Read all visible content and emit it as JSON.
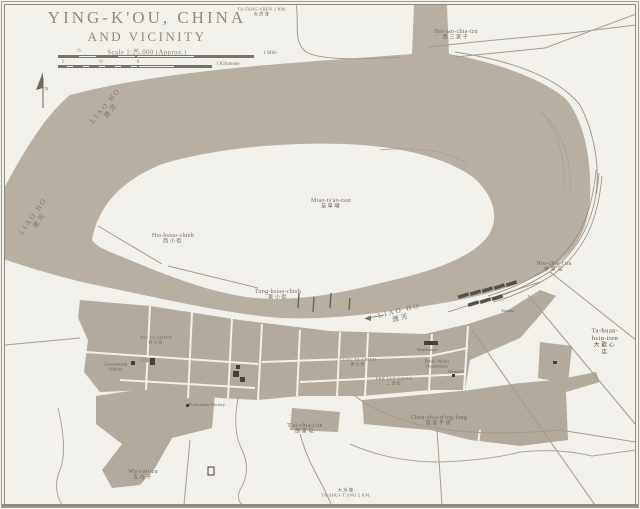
{
  "title": {
    "line1": "YING-K'OU, CHINA",
    "line2": "AND VICINITY",
    "scale_note": "Scale 1:25,000 (Approx.)"
  },
  "compass": {
    "letter": "N"
  },
  "scale_bars": {
    "mile": {
      "labels": [
        {
          "t": "½",
          "x": 21
        },
        {
          "t": "0",
          "x": 78
        }
      ],
      "end_label": "1 Mile",
      "x": 58,
      "y": 46,
      "bar_y": 9,
      "zero": 78,
      "total": 196,
      "left_segs": 4,
      "right_segs": 2
    },
    "km": {
      "labels": [
        {
          "t": "1",
          "x": 5
        },
        {
          "t": "½",
          "x": 43
        },
        {
          "t": "0",
          "x": 80
        }
      ],
      "end_label": "1 Kilometer",
      "x": 58,
      "y": 57,
      "bar_y": 8,
      "zero": 80,
      "total": 154,
      "left_segs": 10,
      "right_segs": 2
    }
  },
  "colors": {
    "paper": "#f1f0ea",
    "water": "#b6afa2",
    "builtup": "#b2ab9d",
    "ink": "#6f695c",
    "title_ink": "#8f8a76",
    "line": "#a29b8d",
    "building": "#45413a"
  },
  "map_labels": [
    {
      "id": "ta-fang-shen",
      "cls": "edge",
      "roman": "TA-FANG-SHEN 2 KM.",
      "chinese": "大房身",
      "x": 262,
      "y": 12,
      "order": "rc"
    },
    {
      "id": "hsi-san-chia-tzu",
      "cls": "place",
      "roman": "Hsi-san-chia-tzu",
      "chinese": "西三家子",
      "x": 456,
      "y": 34,
      "order": "rc"
    },
    {
      "id": "miao-tsao-tsui",
      "cls": "place",
      "roman": "Miao-ts'ao-tsui",
      "chinese": "苗草嘴",
      "x": 331,
      "y": 203,
      "order": "rc"
    },
    {
      "id": "hsi-hsiao-chieh",
      "cls": "place",
      "roman": "Hsi-hsiao-chieh",
      "chinese": "西小街",
      "x": 173,
      "y": 238,
      "order": "rc"
    },
    {
      "id": "tung-hsiao-chieh",
      "cls": "place",
      "roman": "Tung-hsiao-chieh",
      "chinese": "東小街",
      "x": 278,
      "y": 294,
      "order": "rc"
    },
    {
      "id": "niu-chia-tun",
      "cls": "place",
      "roman": "Niu-chia-t'un",
      "chinese": "牛家屯",
      "x": 554,
      "y": 266,
      "order": "rc"
    },
    {
      "id": "ta-huan-hsin-tien",
      "cls": "place-strong",
      "roman": "Ta-huan-hsin-tien",
      "chinese": "大歡心店",
      "x": 605,
      "y": 341,
      "order": "rc"
    },
    {
      "id": "chou-chia-ping-fang",
      "cls": "place",
      "roman": "Chou-chia-p'ing-fang",
      "chinese": "周家平房",
      "x": 439,
      "y": 420,
      "order": "rc"
    },
    {
      "id": "tai-chia-tun",
      "cls": "place",
      "roman": "T'ai-chia-t'un",
      "chinese": "邰家屯",
      "x": 305,
      "y": 428,
      "order": "rc"
    },
    {
      "id": "wu-tai-tzu",
      "cls": "place",
      "roman": "Wu-t'ai-tzu",
      "chinese": "五台子",
      "x": 143,
      "y": 474,
      "order": "rc"
    },
    {
      "id": "ta-shui-tang",
      "cls": "edge",
      "roman": "TA-SHUI-T'ANG 2 KM.",
      "chinese": "大水塘",
      "x": 346,
      "y": 493,
      "order": "cr"
    },
    {
      "id": "liao-ho-upper",
      "cls": "river-lbl",
      "roman": "LIAO HO",
      "chinese": "遼河",
      "x": 108,
      "y": 108,
      "rot": -50,
      "order": "rc"
    },
    {
      "id": "liao-ho-west",
      "cls": "river-lbl",
      "roman": "LIAO HO",
      "chinese": "遼河",
      "x": 36,
      "y": 218,
      "rot": -55,
      "order": "rc"
    },
    {
      "id": "liao-ho-main",
      "cls": "river-lbl",
      "roman": "LIAO HO",
      "chinese": "遼河",
      "x": 400,
      "y": 314,
      "rot": -14,
      "order": "rc"
    },
    {
      "id": "government-offices",
      "cls": "poi",
      "roman": "Government\nOffices",
      "x": 116,
      "y": 367,
      "order": "r"
    },
    {
      "id": "warehouse",
      "cls": "poi",
      "roman": "Warehouse",
      "x": 427,
      "y": 350,
      "order": "r"
    },
    {
      "id": "public-works-department",
      "cls": "poi",
      "roman": "Public Works\nDepartment",
      "x": 437,
      "y": 364,
      "order": "r"
    },
    {
      "id": "hospital",
      "cls": "poi",
      "roman": "Hospital",
      "x": 456,
      "y": 372,
      "order": "r"
    },
    {
      "id": "station",
      "cls": "poi",
      "roman": "Station",
      "x": 508,
      "y": 311,
      "order": "r"
    },
    {
      "id": "firecracker-factory",
      "cls": "poi",
      "roman": "Firecracker Factory",
      "x": 207,
      "y": 405,
      "order": "r"
    },
    {
      "id": "hsi-ta-chieh",
      "cls": "street",
      "roman": "HSI TA CHIEH",
      "chinese": "西大街",
      "x": 156,
      "y": 340,
      "order": "rc"
    },
    {
      "id": "tung-ta-chieh",
      "cls": "street",
      "roman": "TUNG TA CHIEH",
      "chinese": "東大街",
      "x": 358,
      "y": 362,
      "order": "rc"
    },
    {
      "id": "erh-tao-chieh",
      "cls": "street",
      "roman": "ERH TAO CHIEH",
      "chinese": "二道街",
      "x": 394,
      "y": 381,
      "order": "rc"
    }
  ]
}
